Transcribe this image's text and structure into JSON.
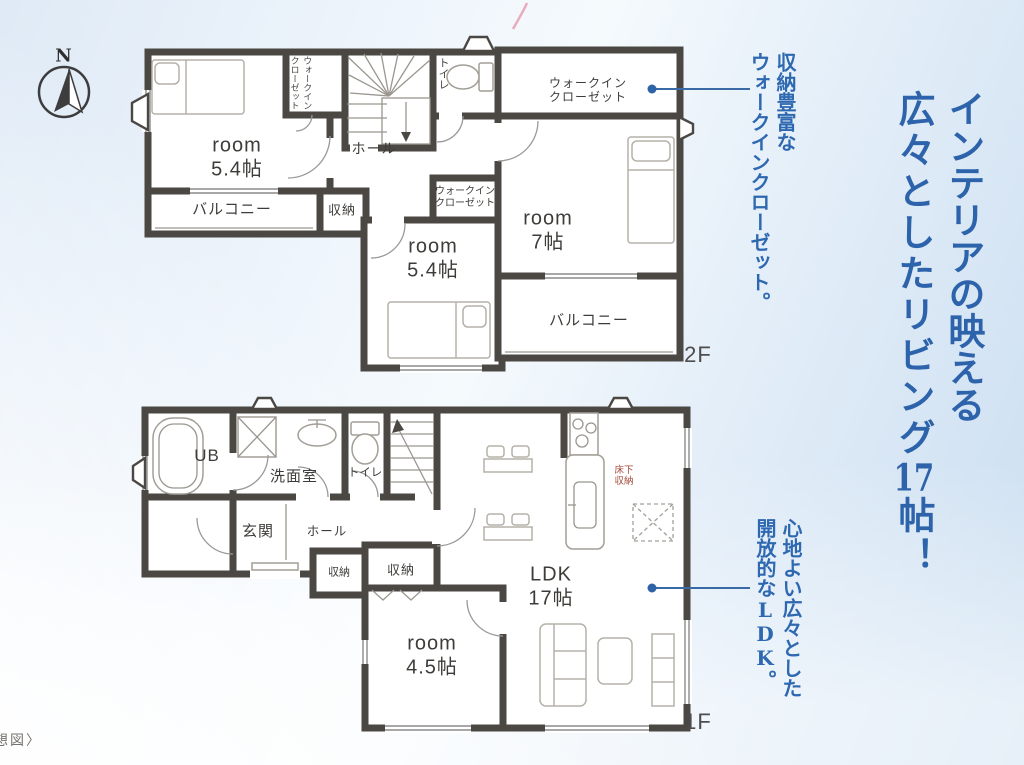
{
  "colors": {
    "headline_blue": "#2d63ab",
    "callout_blue": "#2e68b0",
    "wall_gray": "#4b4743",
    "underfloor_red": "#a34a38",
    "callout_line_blue": "#3a6aa5"
  },
  "compass": {
    "label": "N"
  },
  "headline": {
    "col1": "インテリアの映える",
    "col2_pre": "広々としたリビング",
    "col2_num": "17",
    "col2_post": "帖！"
  },
  "callout_wic": {
    "col1": "収納豊富な",
    "col2": "ウォークインクローゼット。"
  },
  "callout_ldk": {
    "col1": "心地よい広々とした",
    "col2_pre": "開放的な",
    "col2_latin": "LDK",
    "col2_post": "。"
  },
  "floor2": {
    "floor_label": "2F",
    "rooms": {
      "room1": {
        "name": "room",
        "size": "5.4帖"
      },
      "wic1": {
        "col1": "ウォークイン",
        "col2": "クローゼット"
      },
      "toilet": "トイレ",
      "hall": "ホール",
      "balcony1": "バルコニー",
      "storage": "収納",
      "wic2": {
        "line1": "ウォークイン",
        "line2": "クローゼット"
      },
      "room2": {
        "name": "room",
        "size": "5.4帖"
      },
      "wic3": {
        "line1": "ウォークイン",
        "line2": "クローゼット"
      },
      "room3": {
        "name": "room",
        "size": "7帖"
      },
      "balcony2": "バルコニー"
    }
  },
  "floor1": {
    "floor_label": "1F",
    "rooms": {
      "ub": "UB",
      "washroom": "洗面室",
      "toilet": "トイレ",
      "entrance": "玄関",
      "hall": "ホール",
      "storage1": "収納",
      "storage2": "収納",
      "room4": {
        "name": "room",
        "size": "4.5帖"
      },
      "ldk": {
        "name": "LDK",
        "size": "17帖"
      },
      "underfloor": {
        "line1": "床下",
        "line2": "収納"
      }
    }
  },
  "caption": {
    "partial_text": "想図〉"
  }
}
